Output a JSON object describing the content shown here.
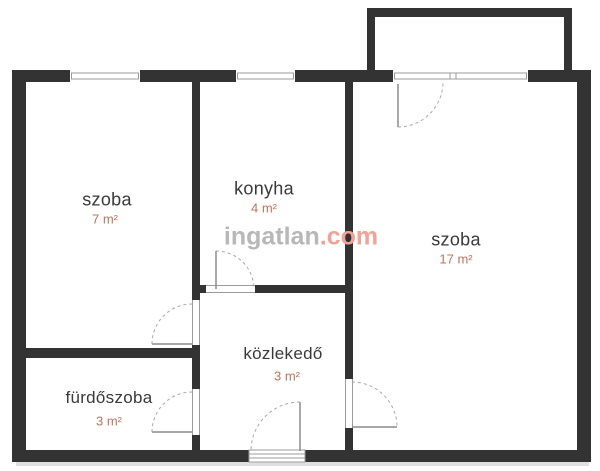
{
  "watermark": {
    "brand": "ingatlan",
    "tld": ".com"
  },
  "colors": {
    "wall": "#333333",
    "fixture": "#9b9b9b",
    "leaf": "#8c8c8c",
    "arc": "#a8a8a8",
    "room_label": "#3a3a3a",
    "area_label": "#c0735e",
    "watermark_brand": "#b8b8b8",
    "watermark_tld": "#f2a296",
    "shadow": "#e0e0e0",
    "background": "#ffffff"
  },
  "rooms": [
    {
      "id": "szoba-left",
      "label": "szoba",
      "area": "7 m²"
    },
    {
      "id": "konyha",
      "label": "konyha",
      "area": "4 m²"
    },
    {
      "id": "szoba-right",
      "label": "szoba",
      "area": "17 m²"
    },
    {
      "id": "kozlekedo",
      "label": "közlekedő",
      "area": "3 m²"
    },
    {
      "id": "furdoszoba",
      "label": "fürdőszoba",
      "area": "3 m²"
    }
  ],
  "plan": {
    "canvas": {
      "w": 600,
      "h": 471
    },
    "walls": [
      {
        "x": 12,
        "y": 70,
        "w": 579,
        "h": 12
      },
      {
        "x": 12,
        "y": 450,
        "w": 579,
        "h": 12
      },
      {
        "x": 12,
        "y": 70,
        "w": 14,
        "h": 392
      },
      {
        "x": 577,
        "y": 70,
        "w": 14,
        "h": 392
      },
      {
        "x": 192,
        "y": 82,
        "w": 8,
        "h": 368
      },
      {
        "x": 345,
        "y": 82,
        "w": 8,
        "h": 368
      },
      {
        "x": 192,
        "y": 285,
        "w": 161,
        "h": 8
      },
      {
        "x": 26,
        "y": 348,
        "w": 166,
        "h": 10
      },
      {
        "x": 367,
        "y": 8,
        "w": 205,
        "h": 9
      },
      {
        "x": 367,
        "y": 8,
        "w": 8,
        "h": 64
      },
      {
        "x": 564,
        "y": 8,
        "w": 8,
        "h": 64
      }
    ],
    "windows": [
      {
        "x": 70,
        "y": 70,
        "w": 70,
        "h": 12,
        "mullions": []
      },
      {
        "x": 236,
        "y": 70,
        "w": 59,
        "h": 12,
        "mullions": []
      },
      {
        "x": 393,
        "y": 70,
        "w": 135,
        "h": 12,
        "mullions": [
          450,
          456
        ]
      }
    ],
    "gaps": [
      {
        "x": 206,
        "y": 285,
        "w": 49,
        "h": 8,
        "orient": "h"
      },
      {
        "x": 192,
        "y": 300,
        "w": 8,
        "h": 45,
        "orient": "v"
      },
      {
        "x": 192,
        "y": 389,
        "w": 8,
        "h": 46,
        "orient": "v"
      },
      {
        "x": 345,
        "y": 379,
        "w": 8,
        "h": 49,
        "orient": "v"
      }
    ],
    "threshold": {
      "x": 249,
      "y": 450,
      "w": 56,
      "h": 12,
      "lines": 2
    },
    "leaves": [
      {
        "x1": 216,
        "y1": 251,
        "x2": 216,
        "y2": 289
      },
      {
        "x1": 152,
        "y1": 344,
        "x2": 192,
        "y2": 344
      },
      {
        "x1": 152,
        "y1": 432,
        "x2": 192,
        "y2": 432
      },
      {
        "x1": 300,
        "y1": 402,
        "x2": 300,
        "y2": 451
      },
      {
        "x1": 352,
        "y1": 427,
        "x2": 397,
        "y2": 427
      },
      {
        "x1": 398,
        "y1": 84,
        "x2": 398,
        "y2": 127
      }
    ],
    "arcs": [
      {
        "x1": 216,
        "y1": 251,
        "r": 38,
        "sweep": 1,
        "x2": 254,
        "y2": 289
      },
      {
        "x1": 152,
        "y1": 344,
        "r": 40,
        "sweep": 1,
        "x2": 192,
        "y2": 304
      },
      {
        "x1": 152,
        "y1": 432,
        "r": 40,
        "sweep": 1,
        "x2": 192,
        "y2": 392
      },
      {
        "x1": 300,
        "y1": 402,
        "r": 49,
        "sweep": 0,
        "x2": 251,
        "y2": 451
      },
      {
        "x1": 352,
        "y1": 382,
        "r": 45,
        "sweep": 1,
        "x2": 397,
        "y2": 427
      },
      {
        "x1": 398,
        "y1": 127,
        "r": 45,
        "sweep": 0,
        "x2": 443,
        "y2": 82
      }
    ],
    "shadow": {
      "x": 16,
      "y": 462,
      "w": 573,
      "h": 4
    }
  }
}
